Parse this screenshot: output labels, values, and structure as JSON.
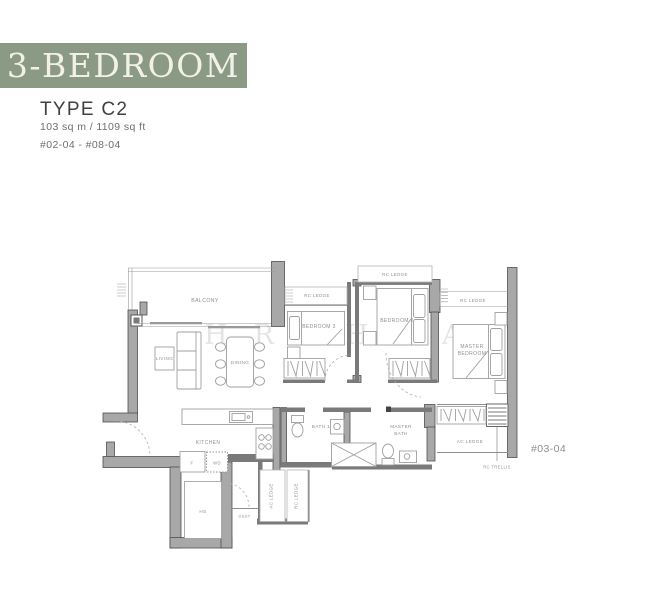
{
  "header": {
    "banner": "3-BEDROOM",
    "type_label": "TYPE C2",
    "area": "103 sq m / 1109 sq ft",
    "units": "#02-04 - #08-04",
    "banner_bg_color": "#8b9a84",
    "banner_text_color": "#f3f1e7"
  },
  "plan": {
    "balcony": "BALCONY",
    "living": "LIVING",
    "dining": "DINING",
    "bedroom3": "BEDROOM 3",
    "bedroom2": "BEDROOM 2",
    "master_line1": "MASTER",
    "master_line2": "BEDROOM",
    "kitchen": "KITCHEN",
    "bath1": "BATH 1",
    "master_bath_line1": "MASTER",
    "master_bath_line2": "BATH",
    "hs": "HS",
    "fridge": "F",
    "washer_dryer": "WD",
    "dst": "D&ST",
    "rc_ledge_a": "RC LEDGE",
    "rc_ledge_b": "RC LEDGE",
    "rc_ledge_c": "RC LEDGE",
    "ac_ledge_vertical": "AC LEDGE",
    "rc_ledge_vertical": "RC LEDGE",
    "ac_ledge_right": "AC LEDGE",
    "rc_trellis": "RC TRELLIS",
    "stack_number": "#03-04",
    "watermark": {
      "w1": "H",
      "w2": "R",
      "w3": "I",
      "w4": "H",
      "w5": "A"
    }
  }
}
